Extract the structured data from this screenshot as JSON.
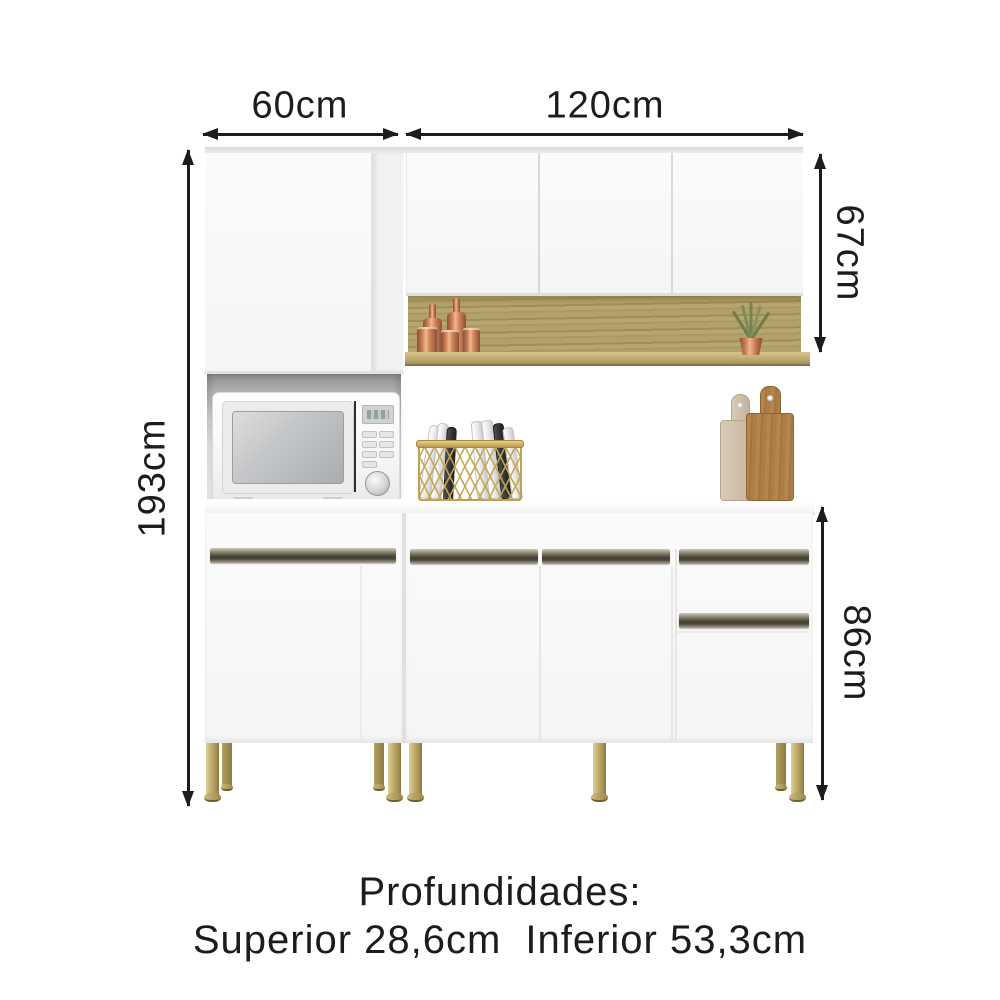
{
  "page": {
    "background": "#ffffff",
    "kind": "furniture dimension diagram"
  },
  "dimensions": {
    "top_left_width": "60cm",
    "top_right_width": "120cm",
    "total_height": "193cm",
    "upper_section_height": "67cm",
    "lower_section_height": "86cm"
  },
  "depths": {
    "heading": "Profundidades:",
    "superior": "Superior 28,6cm",
    "inferior": "Inferior 53,3cm"
  },
  "colors": {
    "dimension_ink": "#1c1c1c",
    "cabinet_white": "#f8f8f8",
    "wood_shelf": "#b2a169",
    "handle_groove_dark": "#403c31",
    "legs_gold": "#c0ad6c",
    "copper_accessories": "#c97c54",
    "plant_green": "#75834f"
  },
  "decor_items": [
    "microwave",
    "copper-canisters",
    "potted-plant",
    "wire-basket-with-plates",
    "cutting-boards"
  ]
}
